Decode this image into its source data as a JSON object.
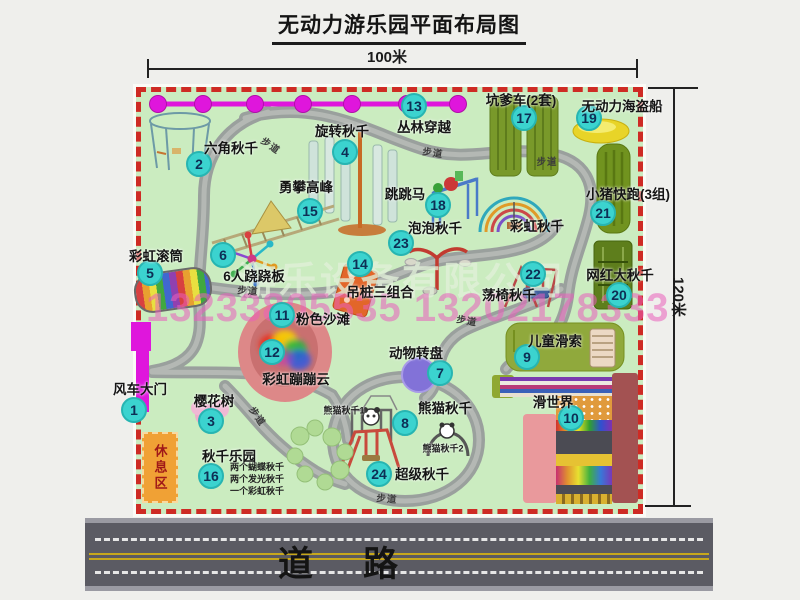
{
  "title": "无动力游乐园平面布局图",
  "dimensions": {
    "width_label": "100米",
    "height_label": "120米"
  },
  "road": {
    "label": "道路"
  },
  "watermark": {
    "company": "游乐设备有限公司",
    "phone": "13233805535 13202178333"
  },
  "rest_area": {
    "label": "休息区"
  },
  "path_label_text": "步道",
  "colors": {
    "park_green": "#cbecc0",
    "border_red": "#ce2b24",
    "badge_cyan": "#3bd3cf",
    "garland_magenta": "#df16dc",
    "road_gray": "#5b5b63",
    "rest_orange": "#f0a135"
  },
  "attractions": [
    {
      "num": 1,
      "name": "风车大门",
      "badge": {
        "x": 134,
        "y": 410
      },
      "label": {
        "x": 140,
        "y": 388
      }
    },
    {
      "num": 2,
      "name": "六角秋千",
      "badge": {
        "x": 199,
        "y": 164
      },
      "label": {
        "x": 231,
        "y": 147
      }
    },
    {
      "num": 3,
      "name": "樱花树",
      "badge": {
        "x": 211,
        "y": 421
      },
      "label": {
        "x": 214,
        "y": 400
      }
    },
    {
      "num": 4,
      "name": "旋转秋千",
      "badge": {
        "x": 345,
        "y": 152
      },
      "label": {
        "x": 342,
        "y": 130
      }
    },
    {
      "num": 5,
      "name": "彩虹滚筒",
      "badge": {
        "x": 150,
        "y": 273
      },
      "label": {
        "x": 156,
        "y": 255
      }
    },
    {
      "num": 6,
      "name": "6人跷跷板",
      "badge": {
        "x": 223,
        "y": 255
      },
      "label": {
        "x": 254,
        "y": 275
      }
    },
    {
      "num": 7,
      "name": "动物转盘",
      "badge": {
        "x": 440,
        "y": 373
      },
      "label": {
        "x": 416,
        "y": 352
      }
    },
    {
      "num": 8,
      "name": "熊猫秋千",
      "badge": {
        "x": 405,
        "y": 423
      },
      "label": {
        "x": 445,
        "y": 407
      }
    },
    {
      "num": 9,
      "name": "儿童滑索",
      "badge": {
        "x": 527,
        "y": 357
      },
      "label": {
        "x": 555,
        "y": 340
      }
    },
    {
      "num": 10,
      "name": "滑世界",
      "badge": {
        "x": 571,
        "y": 418
      },
      "label": {
        "x": 553,
        "y": 401
      }
    },
    {
      "num": 11,
      "name": "粉色沙滩",
      "badge": {
        "x": 282,
        "y": 315
      },
      "label": {
        "x": 323,
        "y": 318
      }
    },
    {
      "num": 12,
      "name": "彩虹蹦蹦云",
      "badge": {
        "x": 272,
        "y": 352
      },
      "label": {
        "x": 296,
        "y": 378
      }
    },
    {
      "num": 13,
      "name": "丛林穿越",
      "badge": {
        "x": 414,
        "y": 106
      },
      "label": {
        "x": 424,
        "y": 126
      }
    },
    {
      "num": 14,
      "name": "吊桩三组合",
      "badge": {
        "x": 360,
        "y": 264
      },
      "label": {
        "x": 380,
        "y": 291
      }
    },
    {
      "num": 15,
      "name": "勇攀高峰",
      "badge": {
        "x": 310,
        "y": 211
      },
      "label": {
        "x": 306,
        "y": 186
      }
    },
    {
      "num": 16,
      "name": "秋千乐园",
      "badge": {
        "x": 211,
        "y": 476
      },
      "label": {
        "x": 229,
        "y": 455
      }
    },
    {
      "num": 17,
      "name": "坑爹车(2套)",
      "badge": {
        "x": 524,
        "y": 118
      },
      "label": {
        "x": 521,
        "y": 99
      }
    },
    {
      "num": 18,
      "name": "跳跳马",
      "badge": {
        "x": 438,
        "y": 205
      },
      "label": {
        "x": 405,
        "y": 193
      }
    },
    {
      "num": 19,
      "name": "无动力海盗船",
      "badge": {
        "x": 589,
        "y": 118
      },
      "label": {
        "x": 622,
        "y": 105
      }
    },
    {
      "num": 20,
      "name": "网红大秋千",
      "badge": {
        "x": 619,
        "y": 295
      },
      "label": {
        "x": 620,
        "y": 274
      }
    },
    {
      "num": 21,
      "name": "小猪快跑(3组)",
      "badge": {
        "x": 603,
        "y": 213
      },
      "label": {
        "x": 628,
        "y": 193
      }
    },
    {
      "num": 22,
      "name": "荡椅秋千",
      "badge": {
        "x": 533,
        "y": 274
      },
      "label": {
        "x": 509,
        "y": 294
      }
    },
    {
      "num": 23,
      "name": "泡泡秋千",
      "badge": {
        "x": 401,
        "y": 243
      },
      "label": {
        "x": 435,
        "y": 227
      }
    },
    {
      "num": 24,
      "name": "超级秋千",
      "badge": {
        "x": 379,
        "y": 474
      },
      "label": {
        "x": 422,
        "y": 473
      }
    }
  ],
  "unnumbered_labels": [
    {
      "name": "彩虹秋千",
      "x": 537,
      "y": 225,
      "small": false
    },
    {
      "name": "熊猫秋千1",
      "x": 344,
      "y": 410,
      "small": true
    },
    {
      "name": "熊猫秋千2",
      "x": 443,
      "y": 448,
      "small": true
    }
  ],
  "swing_park_notes": [
    "两个蝴蝶秋千",
    "两个发光秋千",
    "一个彩虹秋千"
  ],
  "path_labels": [
    {
      "x": 271,
      "y": 145,
      "rotate": 35
    },
    {
      "x": 433,
      "y": 152,
      "rotate": 8
    },
    {
      "x": 547,
      "y": 161,
      "rotate": 0
    },
    {
      "x": 248,
      "y": 290,
      "rotate": 5
    },
    {
      "x": 467,
      "y": 320,
      "rotate": 10
    },
    {
      "x": 258,
      "y": 416,
      "rotate": 55
    },
    {
      "x": 387,
      "y": 498,
      "rotate": 5
    }
  ]
}
